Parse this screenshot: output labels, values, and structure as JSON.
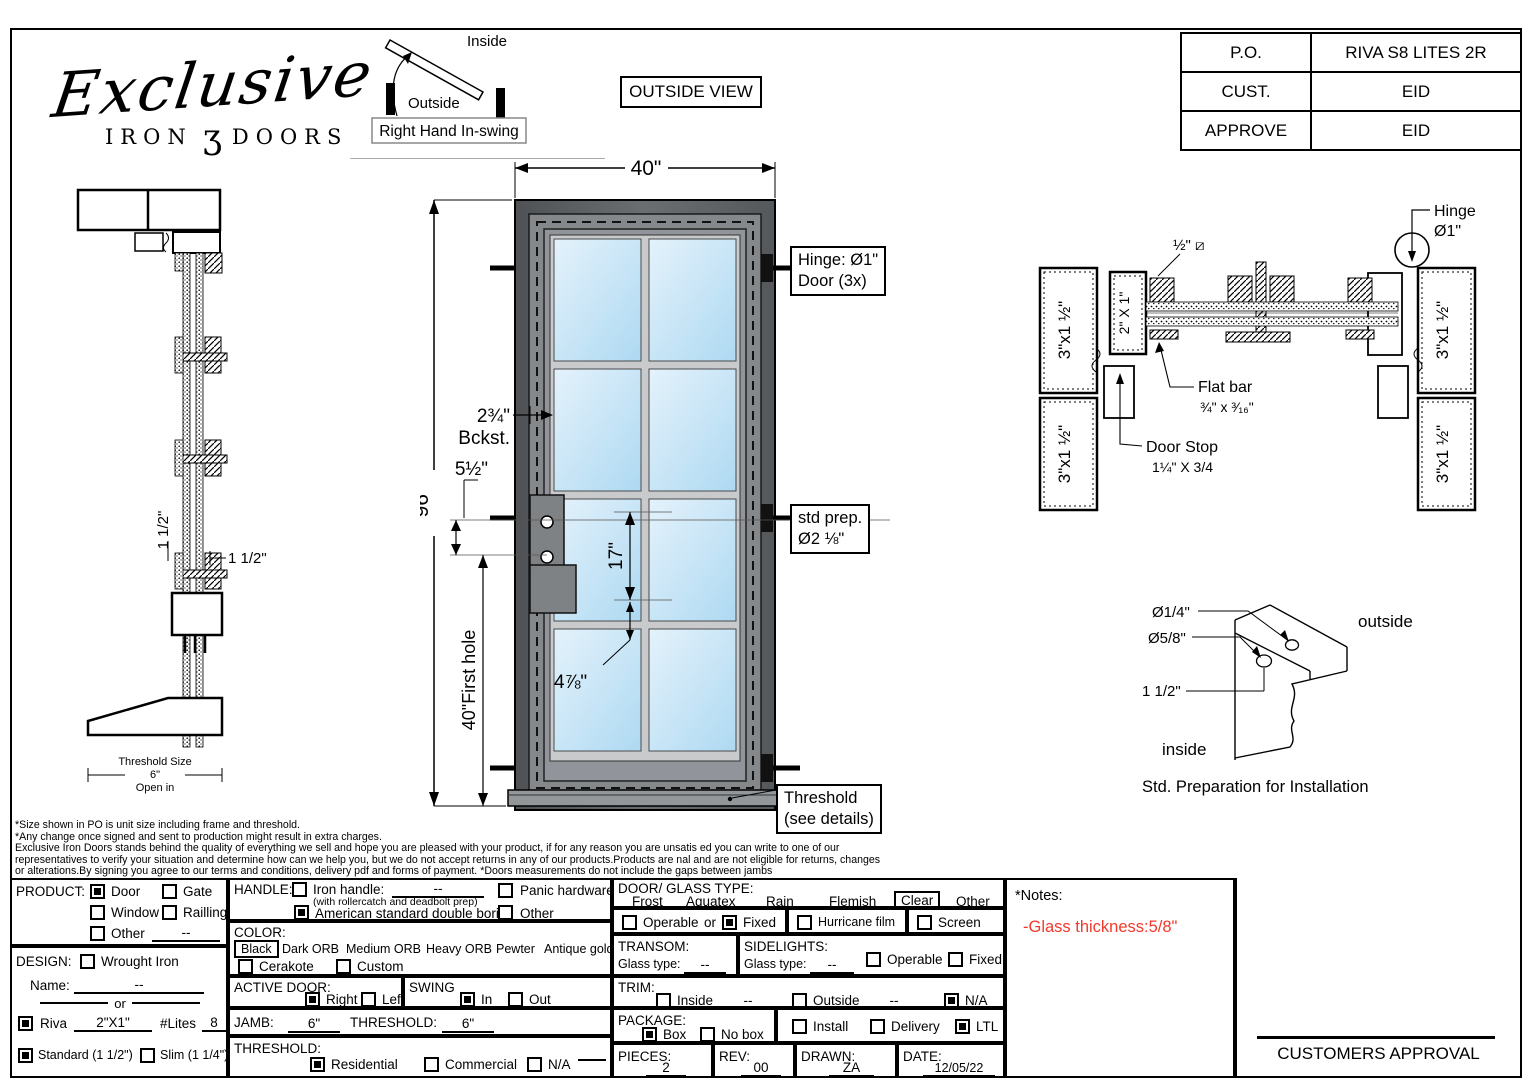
{
  "logo": {
    "script": "Exclusive",
    "word1": "IRON",
    "ornament": "ʒ",
    "word2": "DOORS"
  },
  "swing": {
    "inside": "Inside",
    "outside": "Outside",
    "caption": "Right Hand In-swing"
  },
  "outside_view": "OUTSIDE VIEW",
  "po_table": {
    "rows": [
      {
        "label": "P.O.",
        "value": "RIVA S8 LITES 2R"
      },
      {
        "label": "CUST.",
        "value": "EID"
      },
      {
        "label": "APPROVE",
        "value": "EID"
      }
    ]
  },
  "elevation": {
    "dim_width": "40\"",
    "dim_height": "96\"",
    "backset_line1": "2¾\"",
    "backset_line2": "Bckst.",
    "dim_5_5": "5½\"",
    "dim_17": "17\"",
    "dim_first_hole": "40\"First hole",
    "dim_4_7_8": "4⅞\"",
    "hinge_callout_line1": "Hinge: Ø1\"",
    "hinge_callout_line2": "Door (3x)",
    "stdprep_line1": "std prep.",
    "stdprep_line2": "Ø2 ⅛\"",
    "threshold_line1": "Threshold",
    "threshold_line2": "(see details)"
  },
  "profile": {
    "dim_rot": "1 1/2\"",
    "dim_h": "1 1/2\"",
    "threshold_line1": "Threshold Size",
    "threshold_line2": "6\"",
    "threshold_line3": "Open in"
  },
  "section": {
    "half_sq": "½\" ⧄",
    "tube": "3\"x1 ½\"",
    "tube2": "2\" X 1\"",
    "flat_bar_line1": "Flat bar",
    "flat_bar_line2": "¾\" x ³⁄₁₆\"",
    "door_stop_line1": "Door Stop",
    "door_stop_line2": "1¼\" X 3/4",
    "hinge_line1": "Hinge",
    "hinge_line2": "Ø1\""
  },
  "install": {
    "d1": "Ø1/4\"",
    "d2": "Ø5/8\"",
    "d3": "1 1/2\"",
    "outside": "outside",
    "inside": "inside",
    "caption": "Std. Preparation for Installation"
  },
  "disclaimer": {
    "l1": "*Size shown in PO is unit size including frame and threshold.",
    "l2": "*Any change once signed and sent to production might result in extra charges.",
    "l3": "Exclusive Iron Doors stands behind the quality of everything we sell and hope you are pleased with your product, if for any reason you are unsatis ed you can write to one of our",
    "l4": "representatives to verify your situation and determine how can we help you, but we do not accept returns in any of our products.Products are  nal and are not eligible for returns, changes",
    "l5": "or alterations.By signing you agree to our terms and conditions, delivery pdf and forms of payment. *Doors measurements do not include the gaps between jambs"
  },
  "form": {
    "product": {
      "label": "PRODUCT:",
      "options": [
        {
          "label": "Door",
          "checked": true
        },
        {
          "label": "Gate",
          "checked": false
        },
        {
          "label": "Window",
          "checked": false
        },
        {
          "label": "Railling",
          "checked": false
        },
        {
          "label": "Other",
          "checked": false
        }
      ],
      "other_value": "--"
    },
    "design": {
      "label": "DESIGN:",
      "wrought": {
        "label": "Wrought Iron",
        "checked": false
      },
      "name_label": "Name:",
      "name_value": "--",
      "or": "or"
    },
    "riva": {
      "checked": true,
      "label": "Riva",
      "size": "2\"X1\"",
      "lites_label": "#Lites",
      "lites": "8",
      "standard": {
        "label": "Standard (1 1/2\")",
        "checked": true
      },
      "slim": {
        "label": "Slim (1 1/4\")",
        "checked": false
      }
    },
    "handle": {
      "label": "HANDLE:",
      "iron": {
        "label": "Iron handle:",
        "checked": false
      },
      "iron_value": "--",
      "iron_sub": "(with rollercatch and deadbolt prep)",
      "american": {
        "label": "American standard double boring",
        "checked": true
      },
      "panic": {
        "label": "Panic hardware",
        "checked": false
      },
      "other": {
        "label": "Other",
        "checked": false
      }
    },
    "color": {
      "label": "COLOR:",
      "selected": "Black",
      "finishes": [
        "Dark ORB",
        "Medium ORB",
        "Heavy ORB",
        "Pewter",
        "Antique gold"
      ],
      "cerakote": {
        "label": "Cerakote",
        "checked": false
      },
      "custom": {
        "label": "Custom",
        "checked": false
      }
    },
    "active": {
      "label": "ACTIVE DOOR:",
      "right": {
        "label": "Right",
        "checked": true
      },
      "left": {
        "label": "Left",
        "checked": false
      }
    },
    "swing": {
      "label": "SWING",
      "in": {
        "label": "In",
        "checked": true
      },
      "out": {
        "label": "Out",
        "checked": false
      }
    },
    "jamb": {
      "label": "JAMB:",
      "value": "6\"",
      "t_label": "THRESHOLD:",
      "t_value": "6\""
    },
    "threshold": {
      "label": "THRESHOLD:",
      "residential": {
        "label": "Residential",
        "checked": true
      },
      "commercial": {
        "label": "Commercial",
        "checked": false
      },
      "na": {
        "label": "N/A",
        "checked": false
      }
    },
    "glass": {
      "label": "DOOR/ GLASS TYPE:",
      "selected": "Clear",
      "types": [
        "Frost",
        "Aquatex",
        "Rain",
        "Flemish"
      ],
      "other": "Other",
      "operable": {
        "label": "Operable",
        "checked": false
      },
      "or": "or",
      "fixed": {
        "label": "Fixed",
        "checked": true
      },
      "hurricane": {
        "label": "Hurricane film",
        "checked": false
      },
      "screen": {
        "label": "Screen",
        "checked": false
      }
    },
    "transom": {
      "label": "TRANSOM:",
      "glass_label": "Glass type:",
      "value": "--"
    },
    "sidelights": {
      "label": "SIDELIGHTS:",
      "glass_label": "Glass type:",
      "value": "--",
      "operable": {
        "label": "Operable",
        "checked": false
      },
      "fixed": {
        "label": "Fixed",
        "checked": false
      }
    },
    "trim": {
      "label": "TRIM:",
      "inside": {
        "label": "Inside",
        "checked": false
      },
      "inside_value": "--",
      "outside": {
        "label": "Outside",
        "checked": false
      },
      "outside_value": "--",
      "na": {
        "label": "N/A",
        "checked": true
      }
    },
    "package": {
      "label": "PACKAGE:",
      "box": {
        "label": "Box",
        "checked": true
      },
      "nobox": {
        "label": "No box",
        "checked": false
      },
      "install": {
        "label": "Install",
        "checked": false
      },
      "delivery": {
        "label": "Delivery",
        "checked": false
      },
      "ltl": {
        "label": "LTL",
        "checked": true
      }
    },
    "pieces": {
      "label": "PIECES:",
      "value": "2"
    },
    "rev": {
      "label": "REV:",
      "value": "00"
    },
    "drawn": {
      "label": "DRAWN:",
      "value": "ZA"
    },
    "date": {
      "label": "DATE:",
      "value": "12/05/22"
    },
    "notes": {
      "label": "*Notes:",
      "note": "-Glass thickness:5/8\"",
      "note_color": "#f2392c"
    },
    "approval": {
      "label": "CUSTOMERS APPROVAL"
    }
  }
}
